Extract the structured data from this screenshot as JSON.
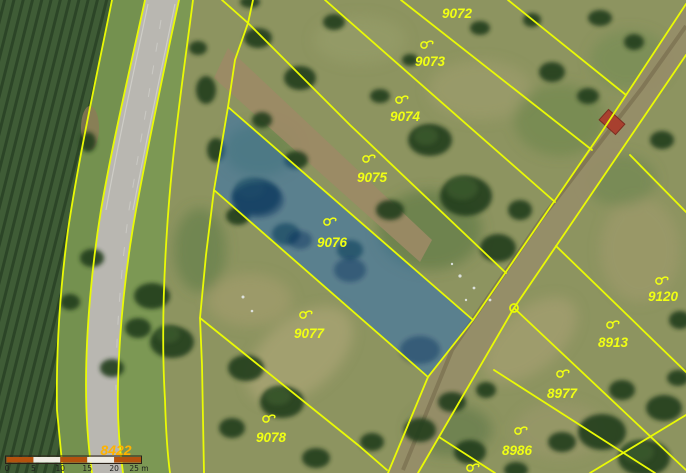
{
  "map": {
    "type": "cadastral-map-over-aerial-imagery",
    "selected_parcel": "9076",
    "parcels": [
      {
        "number": "9072",
        "has_symbol": false
      },
      {
        "number": "9073",
        "has_symbol": true
      },
      {
        "number": "9074",
        "has_symbol": true
      },
      {
        "number": "9075",
        "has_symbol": true
      },
      {
        "number": "9076",
        "has_symbol": true,
        "highlighted": true
      },
      {
        "number": "9077",
        "has_symbol": true
      },
      {
        "number": "9078",
        "has_symbol": true
      },
      {
        "number": "9120",
        "has_symbol": true
      },
      {
        "number": "8913",
        "has_symbol": true
      },
      {
        "number": "8977",
        "has_symbol": true
      },
      {
        "number": "8986",
        "has_symbol": true
      },
      {
        "number": "8422",
        "has_symbol": false,
        "kind": "road-parcel"
      }
    ],
    "icons": {
      "orchard_symbol": "orchard-land-use-symbol",
      "boundary_point": "boundary-point-circle-marker"
    },
    "colors": {
      "boundary_line": "#e9fa05",
      "parcel_label": "#f0ff14",
      "road_parcel_label": "#ffb300",
      "highlight_fill": "rgba(40,108,188,0.5)",
      "scalebar_orange": "#b4520e",
      "scalebar_white": "#efece4"
    }
  },
  "scalebar": {
    "ticks": [
      "0",
      "5",
      "10",
      "15",
      "20",
      "25 m"
    ]
  }
}
